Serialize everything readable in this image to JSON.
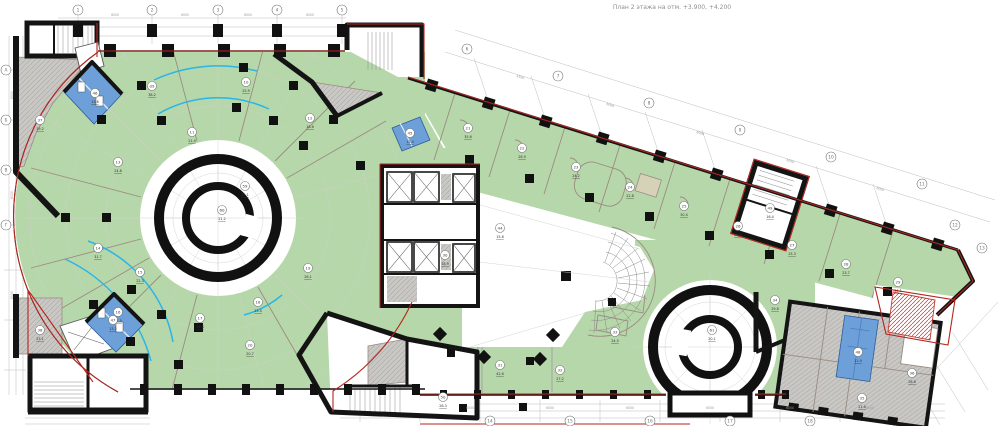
{
  "title": "План 2 этажа на отм. +3.900, +4.200",
  "colors": {
    "floor_green": "#b6d7a9",
    "room_blue": "#6d9fd8",
    "room_gray": "#c9c8c5",
    "boundary_red": "#b3261e",
    "glazing_cyan": "#2ab5e8",
    "wall_black": "#141414"
  },
  "grid": {
    "top": [
      "1",
      "2",
      "3",
      "4",
      "5"
    ],
    "diagonal": [
      "6",
      "7",
      "8",
      "9",
      "10",
      "11",
      "12",
      "13"
    ],
    "left": [
      "А",
      "Б",
      "В",
      "Г"
    ],
    "bottom": [
      "14",
      "15",
      "16",
      "17",
      "18"
    ]
  },
  "dims": {
    "top": [
      "6000",
      "6000",
      "6000",
      "6000"
    ],
    "wing": [
      "4500",
      "6000",
      "6000",
      "6000",
      "6000"
    ],
    "bottom": [
      "6000",
      "6000",
      "6000",
      "6000",
      "6000",
      "6000"
    ],
    "left": [
      "6000",
      "6000",
      "6000"
    ]
  },
  "rooms": [
    {
      "num": "09",
      "area": "38.2"
    },
    {
      "num": "10",
      "area": "25.9"
    },
    {
      "num": "11",
      "area": "21.4"
    },
    {
      "num": "12",
      "area": "18.6"
    },
    {
      "num": "13",
      "area": "24.8"
    },
    {
      "num": "14",
      "area": "31.7"
    },
    {
      "num": "15",
      "area": "22.3"
    },
    {
      "num": "16",
      "area": "27.5"
    },
    {
      "num": "17",
      "area": "19.8"
    },
    {
      "num": "18",
      "area": "23.4"
    },
    {
      "num": "19",
      "area": "26.1"
    },
    {
      "num": "20",
      "area": "20.7"
    },
    {
      "num": "21",
      "area": "35.6"
    },
    {
      "num": "22",
      "area": "28.9"
    },
    {
      "num": "23",
      "area": "24.2"
    },
    {
      "num": "24",
      "area": "22.8"
    },
    {
      "num": "25",
      "area": "30.4"
    },
    {
      "num": "26",
      "area": "21.9"
    },
    {
      "num": "27",
      "area": "25.3"
    },
    {
      "num": "28",
      "area": "23.7"
    },
    {
      "num": "29",
      "area": "34.1"
    },
    {
      "num": "30",
      "area": "18.9"
    },
    {
      "num": "31",
      "area": "42.6"
    },
    {
      "num": "32",
      "area": "27.2"
    },
    {
      "num": "33",
      "area": "24.5"
    },
    {
      "num": "34",
      "area": "29.8"
    },
    {
      "num": "35",
      "area": "21.6"
    },
    {
      "num": "36",
      "area": "26.8"
    },
    {
      "num": "37",
      "area": "19.2"
    },
    {
      "num": "38",
      "area": "23.1"
    },
    {
      "num": "59",
      "area": "25.1"
    },
    {
      "num": "60",
      "area": "21.2"
    },
    {
      "num": "61",
      "area": "20.1"
    },
    {
      "num": "44",
      "area": "15.8"
    },
    {
      "num": "45",
      "area": "12.4"
    },
    {
      "num": "46",
      "area": "13.6"
    },
    {
      "num": "47",
      "area": "13.2"
    },
    {
      "num": "48",
      "area": "11.9"
    },
    {
      "num": "49",
      "area": "16.4"
    },
    {
      "num": "50",
      "area": "28.3"
    }
  ]
}
